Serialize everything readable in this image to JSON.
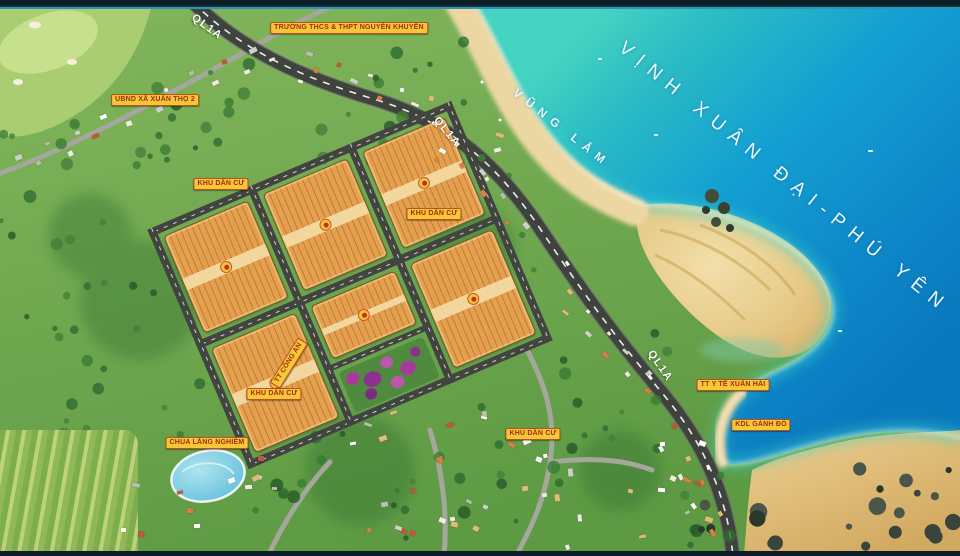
{
  "map": {
    "title": "VỊNH XUÂN ĐẠI-PHÚ YÊN",
    "bay": "VŨNG LẮM",
    "highway": "QL1A",
    "poi": {
      "school": "TRƯỜNG THCS & THPT NGUYỄN KHUYẾN",
      "ubnd": "UBND XÃ XUÂN THỌ 2",
      "kdc": "KHU DÂN CƯ",
      "chua": "CHÙA LĂNG NGHIÊM",
      "cong_an": "TT CÔNG AN",
      "y_te": "TT Y TẾ XUÂN HẢI",
      "kdl": "KDL GÀNH ĐỎ"
    },
    "colors": {
      "label_bg": "#f8c737",
      "label_text": "#9e2b10",
      "highway_text": "#ffffff",
      "water_text": "#eef9ff",
      "sea_deep": "#0d86c8",
      "sea_shallow": "#3ed2c6",
      "sand": "#e9c87e",
      "land": "#6fa94e",
      "road": "#3f433d",
      "lot_orange": "#e5a04f"
    }
  }
}
